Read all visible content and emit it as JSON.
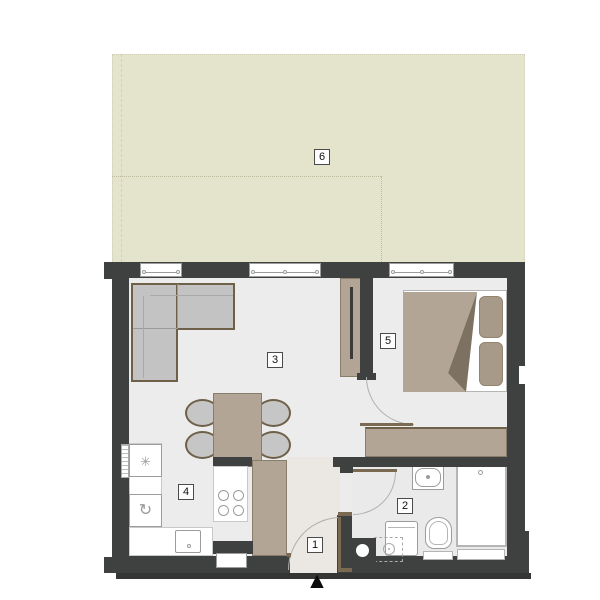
{
  "plan": {
    "type": "apartment-floor-plan",
    "rooms": {
      "hallway": {
        "label": "1"
      },
      "bathroom": {
        "label": "2"
      },
      "living_room": {
        "label": "3"
      },
      "kitchen": {
        "label": "4"
      },
      "bedroom": {
        "label": "5"
      },
      "terrace": {
        "label": "6"
      }
    },
    "symbols": {
      "freezer_icon": "✳",
      "rotation_icon": "↻",
      "entrance_arrow": "▲"
    },
    "colors": {
      "wall": "#3f4040",
      "floor": "#ececec",
      "hall_floor": "#ebe8e3",
      "terrace": "#e4e3cb",
      "furniture_wood": "#b2a595",
      "furniture_outline": "#6f6049",
      "upholstery_gray": "#c3c3c3",
      "pillow_tan": "#a89a89",
      "fixture_outline": "#9c9c9c",
      "door_leaf": "#7a6a52",
      "door_arc": "#b0b0b0"
    }
  }
}
